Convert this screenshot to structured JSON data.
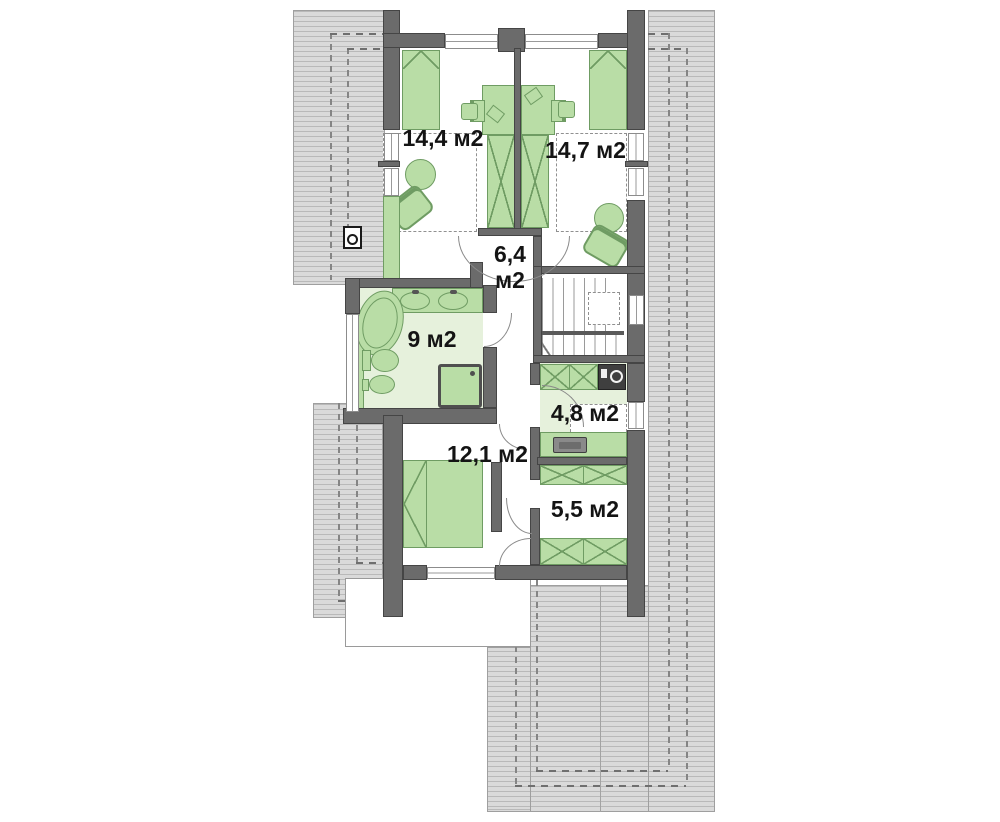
{
  "rooms": {
    "bedroom_top_left": {
      "area": "14,4 м2"
    },
    "bedroom_top_right": {
      "area": "14,7 м2"
    },
    "hall": {
      "area_value": "6,4",
      "area_unit": "м2"
    },
    "bathroom": {
      "area": "9 м2"
    },
    "laundry": {
      "area": "4,8 м2"
    },
    "bedroom_bottom": {
      "area": "12,1 м2"
    },
    "wardrobe_room": {
      "area": "5,5 м2"
    }
  },
  "icons": {
    "roof_window": "roof-window-icon"
  },
  "colors": {
    "furniture_green": "#b9dda6",
    "furniture_green_dark": "#6f9c63",
    "floor_green": "#e6f1dc",
    "wall_gray": "#6b6b6b",
    "wall_dark": "#454545",
    "roof_fill": "#dadada",
    "roof_stripe": "#b9b9b9",
    "text_color": "#141414"
  }
}
